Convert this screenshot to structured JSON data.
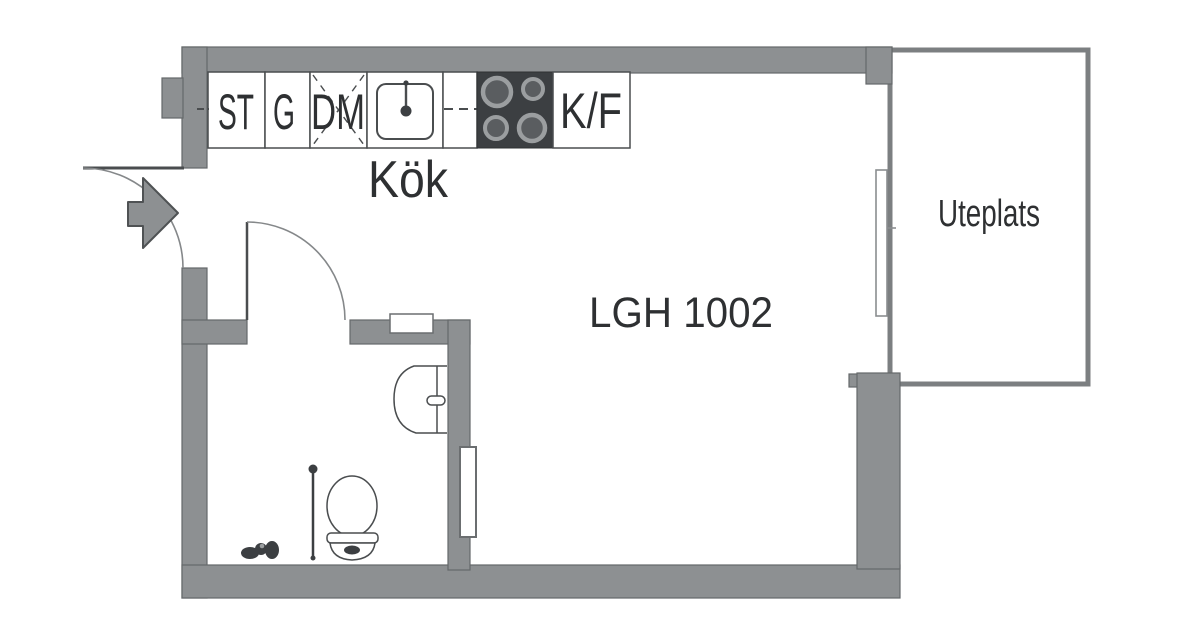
{
  "title": "Floor plan",
  "labels": {
    "apartment": "LGH 1002",
    "kitchen": "Kök",
    "patio": "Uteplats"
  },
  "kitchen": {
    "cabinets": [
      "ST",
      "G",
      "DM"
    ],
    "fridge_freezer": "K/F"
  },
  "entrance": {
    "arrow_direction": "right"
  },
  "fixtures": [
    "kitchen-sink",
    "stove",
    "fridge-freezer",
    "dishwasher",
    "bathroom-sink",
    "toilet",
    "shower-rail",
    "radiator",
    "balcony-door"
  ],
  "colors": {
    "wall": "#8d9092",
    "wall_stroke": "#65686a",
    "line": "#4a4d4f",
    "arc": "#85888a",
    "stove": "#3c3f42",
    "burner_ring": "#9b9ea0",
    "burner_center": "#5a5d60",
    "patio_border": "#7c7f81",
    "text": "#2e3032"
  }
}
